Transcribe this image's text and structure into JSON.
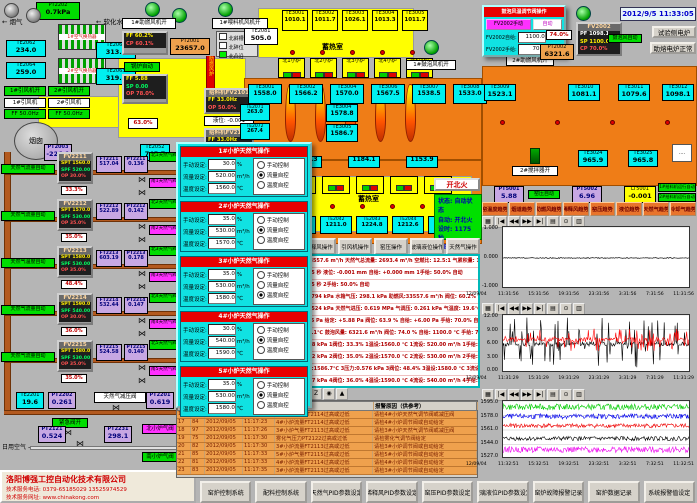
{
  "datetime": "2012/9/5 11:33:05",
  "flue": {
    "pt2202_tag": "PT2202",
    "pt2202_val": "0.7kPa",
    "gas": "烟气",
    "water": "软化水",
    "ex1": "1#空气换热器",
    "ex2": "2#空气换热器",
    "te": [
      {
        "tag": "TE2062",
        "v": "234.0"
      },
      {
        "tag": "TE2064",
        "v": "259.0"
      },
      {
        "tag": "TE2061",
        "v": "313.0"
      },
      {
        "tag": "TE2063",
        "v": "319.0"
      }
    ],
    "fan_on": [
      "1#引风机开",
      "2#引风机开"
    ],
    "fans": [
      {
        "name": "1#引风机",
        "ff": "FF 50.0Hz"
      },
      {
        "name": "2#引风机",
        "ff": "FF 50.0Hz"
      }
    ],
    "chimney": "烟囱",
    "damper": "63.0%",
    "duct": "助燃风炉"
  },
  "blower": {
    "fan1": "1#助燃风机开",
    "feedfan": "1#喂料机风机开",
    "legend": [
      "北斜槽",
      "北碎位",
      "北凸沿"
    ],
    "fv2001": {
      "t": "FV2001",
      "ff": "FF 60.2%",
      "cp": "CP 60.1%"
    },
    "pt2001": {
      "tag": "PT2001",
      "v": "23657.0"
    },
    "boiler": "锅炉自动",
    "fv2003": {
      "t": "FV2003",
      "ff": "FF 5.88",
      "sp": "SP 0.00",
      "op": "OP 78.0%"
    },
    "feeder1": {
      "t": "给料机FV2101",
      "ff": "FF 33.0Hz",
      "op": "OP 50.0%"
    },
    "level": "液位: -0.001",
    "feeder2": {
      "t": "给料机FV2102",
      "ff": "FF 33.0Hz",
      "op": "OP 50.0%"
    }
  },
  "furnace": {
    "regen_label": "蓄热室",
    "regen_label2": "蓄热室",
    "te2081": {
      "tag": "TE2081",
      "v": "505.0"
    },
    "regen": [
      {
        "tag": "TE3001",
        "v": "1010.1"
      },
      {
        "tag": "TE3002",
        "v": "1011.7"
      },
      {
        "tag": "TE3003",
        "v": "1026.1"
      },
      {
        "tag": "TE3004",
        "v": "1013.3"
      },
      {
        "tag": "TE3005",
        "v": "1011.7"
      }
    ],
    "north": [
      "北1小炉",
      "北2小炉",
      "北3小炉",
      "北4小炉",
      "北5小炉"
    ],
    "south": [
      "南1小炉",
      "南2小炉",
      "南3小炉",
      "南4小炉",
      "南5小炉"
    ],
    "wall": [
      {
        "tag": "TE2071",
        "v": "263.0"
      },
      {
        "tag": "TE2072",
        "v": "267.4"
      },
      {
        "tag": "TE2073",
        "v": "269.6"
      },
      {
        "tag": "TE2074",
        "v": "268.6"
      }
    ],
    "crown": [
      {
        "tag": "TE3001",
        "v": "1558.0"
      },
      {
        "tag": "TE3002",
        "v": "1566.2"
      },
      {
        "tag": "TE3004",
        "v": "1570.0"
      },
      {
        "tag": "TE3006",
        "v": "1567.5"
      },
      {
        "tag": "TE3007",
        "v": "1538.5"
      },
      {
        "tag": "TE3008",
        "v": "1533.0"
      }
    ],
    "crown_stack": [
      {
        "tag": "TE3004",
        "v": "1578.8"
      },
      {
        "tag": "TE3005",
        "v": "1586.7"
      }
    ],
    "south_top": [
      "1166.3",
      "1184.1",
      "1153.9"
    ],
    "south_te": [
      {
        "tag": "TE2041",
        "v": "1209.6"
      },
      {
        "tag": "TE2042",
        "v": "1211.0"
      },
      {
        "tag": "TE2043",
        "v": "1224.8"
      },
      {
        "tag": "TE2044",
        "v": "1212.6"
      },
      {
        "tag": "TE2045",
        "v": "1211.6"
      }
    ],
    "right_te": [
      {
        "tag": "TE3009",
        "v": "1523.1"
      },
      {
        "tag": "TE3010",
        "v": "1081.1"
      },
      {
        "tag": "TE3011",
        "v": "1079.6"
      },
      {
        "tag": "TE3012",
        "v": "1098.1"
      }
    ],
    "right_te2": [
      {
        "tag": "TE3024",
        "v": "965.9"
      },
      {
        "tag": "TE3025",
        "v": "965.8"
      }
    ],
    "bubfan": "1#鼓泡风机开",
    "stirrer": "2#搅拌器开",
    "blower2": "2#助燃风机开"
  },
  "bubbler": {
    "title": "鼓泡风温调节阀操作",
    "manual_btn": "FV2002手动",
    "auto_btn": "自动",
    "l1": "FV2002自给:",
    "v1": "1100.0",
    "u1": "℃",
    "l2": "FV2002手给:",
    "v2": "70.0",
    "u2": "%",
    "fv2002": {
      "t": "FV2002",
      "pf": "PF 1098.1",
      "sp": "SP 1100.0",
      "cp": "CP 70.0%"
    },
    "auto_label": "鼓泡风自动",
    "pct": "74.0%",
    "pt2002": {
      "tag": "PT2002",
      "v": "6321.6"
    },
    "btn_test": "试验侧电炉",
    "btn_melt": "助熔电炉正常"
  },
  "fire": {
    "btn": "开北火",
    "rows": [
      "状态: 自动状态",
      "自动: 开北火",
      "设时: 1175 秒",
      "计时: 269 秒"
    ]
  },
  "ops_buttons": [
    "助燃风操作",
    "稀释风操作",
    "引风机操作",
    "窑压操作",
    "玻璃液位操作",
    "天然气操作"
  ],
  "info_rows": [
    "助燃风量:33557.6 m³/h  天然气总流量: 2693.4 m³/h  空燃比: 12.5:1  气累积量: 134057.7 m³",
    "换火设定: 25 秒    液位: -0.001 mm   自给: +0.000 mm   1手给: 50.0%  自动",
    "换火计时: 25 秒    2手给: 50.0%  自动",
    "氮气压力:0.794 kPa   水箱气压: 298.1 kPa   助燃风:33557.6 m³/h  阀位: 60.2%  设定: 60.0%",
    "煤气压力:0.524 kPa   天然气进压: 0.619 MPa   气调压: 0.261 kPa   气温度: 19.6℃",
    "窑压: +6.96 Pa  给定: +5.88 Pa  阀位: 63.9 %  自给: +6.00 Pa  手给: 70.0%  自动",
    "鼓泡: 1098.1℃  鼓泡风量: 6321.6 m³/h  阀位: 74.0 %  自给: 1100.0 ℃  手给: 70.0%  自动",
    "1压力:0.638 kPa  1阀位: 33.3%  1温设:1560.0 ℃  1流设: 520.00 m³/h  1手给: 30.0%  流控",
    "2压力:0.542 kPa  2阀位: 35.0%  2温设:1570.0 ℃  2流设: 530.00 m³/h  2手给: 35.0%  流控",
    "3#液面温度:1586.7℃  3压力:0.576 kPa  3阀位: 48.4%  3温设:1580.0 ℃  3流设: 530.00 m³/h  温控",
    "4压力:0.547 kPa  4阀位: 36.0%  4温设:1590.0 ℃  4流设: 540.00 m³/h  4手给: 30.0%  流控",
    "5压力:0.540 kPa  5阀位: 35.0%  5温设:1580.0 ℃  5流设: 530.00 m³/h  5手给: 35.0%  流控"
  ],
  "dialog": {
    "labels": {
      "manual": "手动设定:",
      "flow": "流量设定:",
      "temp": "温度设定:",
      "u_pct": "%",
      "u_flow": "m³/h",
      "u_temp": "℃",
      "r1": "手动控制",
      "r2": "流量自控",
      "r3": "温度自控"
    },
    "panels": [
      {
        "title": "1#小炉天然气操作",
        "manual": "30.0",
        "flow": "520.00",
        "temp": "1560.0",
        "m1": false,
        "m2": true,
        "m3": false
      },
      {
        "title": "2#小炉天然气操作",
        "manual": "35.0",
        "flow": "530.00",
        "temp": "1570.0",
        "m1": false,
        "m2": true,
        "m3": false
      },
      {
        "title": "3#小炉天然气操作",
        "manual": "35.0",
        "flow": "530.00",
        "temp": "1580.0",
        "m1": false,
        "m2": false,
        "m3": true
      },
      {
        "title": "4#小炉天然气操作",
        "manual": "30.0",
        "flow": "540.00",
        "temp": "1590.0",
        "m1": false,
        "m2": true,
        "m3": false
      },
      {
        "title": "5#小炉天然气操作",
        "manual": "35.0",
        "flow": "530.00",
        "temp": "1580.0",
        "m1": false,
        "m2": true,
        "m3": false
      }
    ]
  },
  "loops": [
    {
      "auto": "天然气流量自动",
      "fv": "FV2211",
      "spt": "SPT 1560.0",
      "spf": "SPF 520.00",
      "op": "OP 30.0%",
      "pct": "33.3%",
      "ft_tag": "FT2211",
      "ft": "517.04",
      "pt_tag": "PT2211",
      "pt": "0.136",
      "north": "北1天然气阀",
      "south": "南1天然气阀"
    },
    {
      "auto": "天然气流量自动",
      "fv": "FV2212",
      "spt": "SPT 1570.0",
      "spf": "SPF 530.00",
      "op": "OP 35.0%",
      "pct": "35.0%",
      "ft_tag": "FT2212",
      "ft": "522.89",
      "pt_tag": "PT2212",
      "pt": "0.142",
      "north": "北2天然气阀",
      "south": "南2天然气阀"
    },
    {
      "auto": "天然气温度自动",
      "fv": "FV2213",
      "spt": "SPT 1580.0",
      "spf": "SPF 530.00",
      "op": "OP 35.0%",
      "pct": "48.4%",
      "ft_tag": "FT2213",
      "ft": "603.19",
      "pt_tag": "PT2213",
      "pt": "0.178",
      "north": "北3天然气阀",
      "south": "南3天然气阀"
    },
    {
      "auto": "天然气流量自动",
      "fv": "FV2214",
      "spt": "SPT 1590.0",
      "spf": "SPF 540.00",
      "op": "OP 30.0%",
      "pct": "36.0%",
      "ft_tag": "FT2214",
      "ft": "532.44",
      "pt_tag": "PT2214",
      "pt": "0.147",
      "north": "北4天然气阀",
      "south": "南4天然气阀"
    },
    {
      "auto": "天然气流量自动",
      "fv": "FV2215",
      "spt": "SPT 1580.0",
      "spf": "SPF 530.00",
      "op": "OP 35.0%",
      "pct": "35.0%",
      "ft_tag": "FT2215",
      "ft": "524.58",
      "pt_tag": "PT2215",
      "pt": "0.140",
      "north": "北5天然气阀",
      "south": "南5天然气阀"
    }
  ],
  "gasline": {
    "pt2003": {
      "tag": "PT2003",
      "v": "-226.1"
    },
    "te2052": {
      "tag": "TE2052",
      "v": "745.7"
    },
    "te2201": {
      "tag": "TE2201",
      "v": "19.6"
    },
    "pt2202": {
      "tag": "PT2202",
      "v": "0.261"
    },
    "emerg": "紧急阀开",
    "reducer": "天然气减压阀",
    "pt2201": {
      "tag": "PT2201",
      "v": "0.619"
    },
    "air": "日用空气",
    "pt2121": {
      "tag": "PT2121",
      "v": "0.524"
    },
    "pt2231": {
      "tag": "PT2231",
      "v": "298.1"
    },
    "nvalve": "北小炉气阀",
    "svalve": "南小炉气阀"
  },
  "melter_status": {
    "pt5001": {
      "tag": "PT5001",
      "v": "5.88"
    },
    "yayun": "窑压自动",
    "pt5002": {
      "tag": "PT5002",
      "v": "6.96"
    },
    "lt5001": {
      "tag": "LT5001",
      "v": "-0.001"
    },
    "feed_auto": [
      "1#给料机运行自动",
      "2#给料机运行自动"
    ]
  },
  "trend_buttons": [
    "窑温度趋势",
    "烟道趋势",
    "助燃风趋势",
    "稀释风趋势",
    "窑压趋势",
    "液位趋势",
    "天然气趋势",
    "冷却气趋势"
  ],
  "alarm": {
    "toolbar": [
      "▤",
      "☰",
      "?",
      "▥",
      "▦",
      "▣",
      "Z",
      "◉",
      "▲"
    ],
    "h_point": "报警点",
    "h_reason": "报警原因（供参考）",
    "rows": [
      {
        "seq": "16",
        "code": "90",
        "date": "2012/09/05",
        "time": "11:17:21",
        "point": "4#小炉气量FT2114过高或过低",
        "reason": "请检4#小炉天然气调节阀或减压阀"
      },
      {
        "seq": "17",
        "code": "84",
        "date": "2012/09/05",
        "time": "11:17:23",
        "point": "4#小炉流量FT2114过高或过低",
        "reason": "请检4#小炉调节阀或自动给定"
      },
      {
        "seq": "18",
        "code": "97",
        "date": "2012/09/05",
        "time": "11:17:26",
        "point": "3#小炉气量FT2113过高或过低",
        "reason": "请检3#小炉天然气调节阀或减压阀"
      },
      {
        "seq": "19",
        "code": "75",
        "date": "2012/09/05",
        "time": "11:17:30",
        "point": "雾化气压力PT2122过高或过低",
        "reason": "请检雾化气调节阀给定"
      },
      {
        "seq": "20",
        "code": "82",
        "date": "2012/09/05",
        "time": "11:17:30",
        "point": "3#小炉流量FT2113过高或过低",
        "reason": "请检3#小炉调节阀或自动给定"
      },
      {
        "seq": "21",
        "code": "85",
        "date": "2012/09/05",
        "time": "11:17:33",
        "point": "5#小炉气量FT2115过高或过低",
        "reason": "请检5#小炉调节阀或自动给定"
      },
      {
        "seq": "22",
        "code": "81",
        "date": "2012/09/05",
        "time": "11:17:33",
        "point": "4#小炉流量FT2114过高或过低",
        "reason": "请检4#小炉调节阀或自动给定"
      },
      {
        "seq": "23",
        "code": "83",
        "date": "2012/09/05",
        "time": "11:17:35",
        "point": "3#小炉流量FT2113过高或过低",
        "reason": "请检3#小炉调节阀或自动给定"
      }
    ]
  },
  "chart_toolbar": [
    "▦",
    "|◀",
    "◀◀",
    "▶▶",
    "▶|",
    "▤",
    "⊙",
    "▥"
  ],
  "chart_data": [
    {
      "type": "line",
      "title": "窑压趋势",
      "ylim": [
        -1,
        1
      ],
      "yticks": [
        "1.000",
        "0.000",
        "-1.000"
      ],
      "xdate": "12/09/04",
      "xticks": [
        "11:31:56",
        "15:31:56",
        "19:31:56",
        "23:31:56",
        "3:31:56",
        "7:31:56",
        "11:31:56"
      ],
      "series": [
        {
          "name": "玻璃液位",
          "color": "#000000",
          "base": 0.0,
          "amp": 0.03,
          "style": "flat"
        }
      ]
    },
    {
      "type": "line",
      "title": "窑压/鼓泡趋势",
      "ylim": [
        0,
        12
      ],
      "yticks": [
        "12.00",
        "9.00",
        "6.00",
        "3.00",
        "0.00"
      ],
      "xdate": "12/09/04",
      "xticks": [
        "11:31:29",
        "15:31:29",
        "19:31:29",
        "23:31:29",
        "3:31:29",
        "7:31:29",
        "11:31:29"
      ],
      "series": [
        {
          "name": "窑压实测",
          "color": "#000000",
          "base": 6.0,
          "amp": 5.5,
          "style": "noise"
        },
        {
          "name": "窑压给定",
          "color": "#ff0000",
          "base": 6.9,
          "amp": 2.4,
          "style": "noise"
        }
      ]
    },
    {
      "type": "line",
      "title": "小炉温度趋势",
      "ylim": [
        1527,
        1595
      ],
      "yticks": [
        "1595.0",
        "1578.0",
        "1561.0",
        "1544.0",
        "1527.0"
      ],
      "xdate": "12/09/04",
      "xticks": [
        "11:32:51",
        "15:32:51",
        "19:32:51",
        "23:32:51",
        "3:32:51",
        "7:32:51",
        "11:32:51"
      ],
      "series": [
        {
          "name": "1#小炉",
          "color": "#00cc00",
          "base": 1588,
          "amp": 3.5,
          "style": "band"
        },
        {
          "name": "2#小炉",
          "color": "#0000ee",
          "base": 1577,
          "amp": 3.0,
          "style": "band"
        },
        {
          "name": "3#小炉",
          "color": "#ee0000",
          "base": 1566,
          "amp": 2.5,
          "style": "band"
        },
        {
          "name": "4#小炉",
          "color": "#000000",
          "base": 1551,
          "amp": 2.5,
          "style": "band"
        },
        {
          "name": "5#小炉",
          "color": "#ee00ee",
          "base": 1538,
          "amp": 3.5,
          "style": "band"
        }
      ]
    }
  ],
  "bottom_buttons": [
    "窑炉控制系统",
    "配料控制系统",
    "天然气PID参数设定",
    "稀释风PID参数设定",
    "窑压PID参数设定",
    "玻璃液位PID参数设定",
    "窑炉故障报警记录",
    "窑炉数据记录",
    "系统报警值设定"
  ],
  "company": {
    "name": "洛阳博强工控自动化技术有限公司",
    "tel": "技术服务电话: 0379-65185029  13525974529",
    "web": "技术服务网址: www.chinakong.com"
  }
}
